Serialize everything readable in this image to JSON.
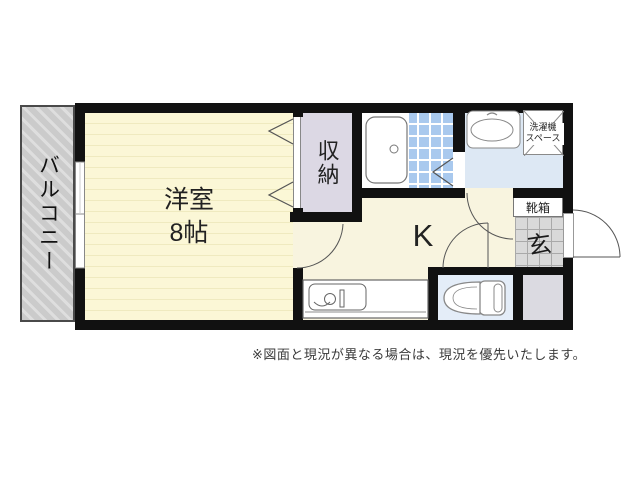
{
  "floorplan": {
    "balcony_label": "バルコニー",
    "western_room_label": "洋室",
    "western_room_size": "8帖",
    "closet_label": "収納",
    "kitchen_label": "K",
    "genkan_label": "玄",
    "shoe_box_label": "靴箱",
    "laundry_label_line1": "洗濯機",
    "laundry_label_line2": "スペース",
    "disclaimer": "※図面と現況が異なる場合は、現況を優先いたします。"
  },
  "colors": {
    "wall": "#111111",
    "western_room_floor": "#fbf7d6",
    "kitchen_floor": "#f8f4df",
    "closet_floor": "#dcd8e4",
    "bath_tile": "#a9c9ee",
    "washroom_floor": "#dde8f4",
    "toilet_floor": "#e4edf8",
    "balcony": "#cbcbcb",
    "genkan_tile": "#d9d9d9",
    "storage_gray": "#dbdae1"
  }
}
